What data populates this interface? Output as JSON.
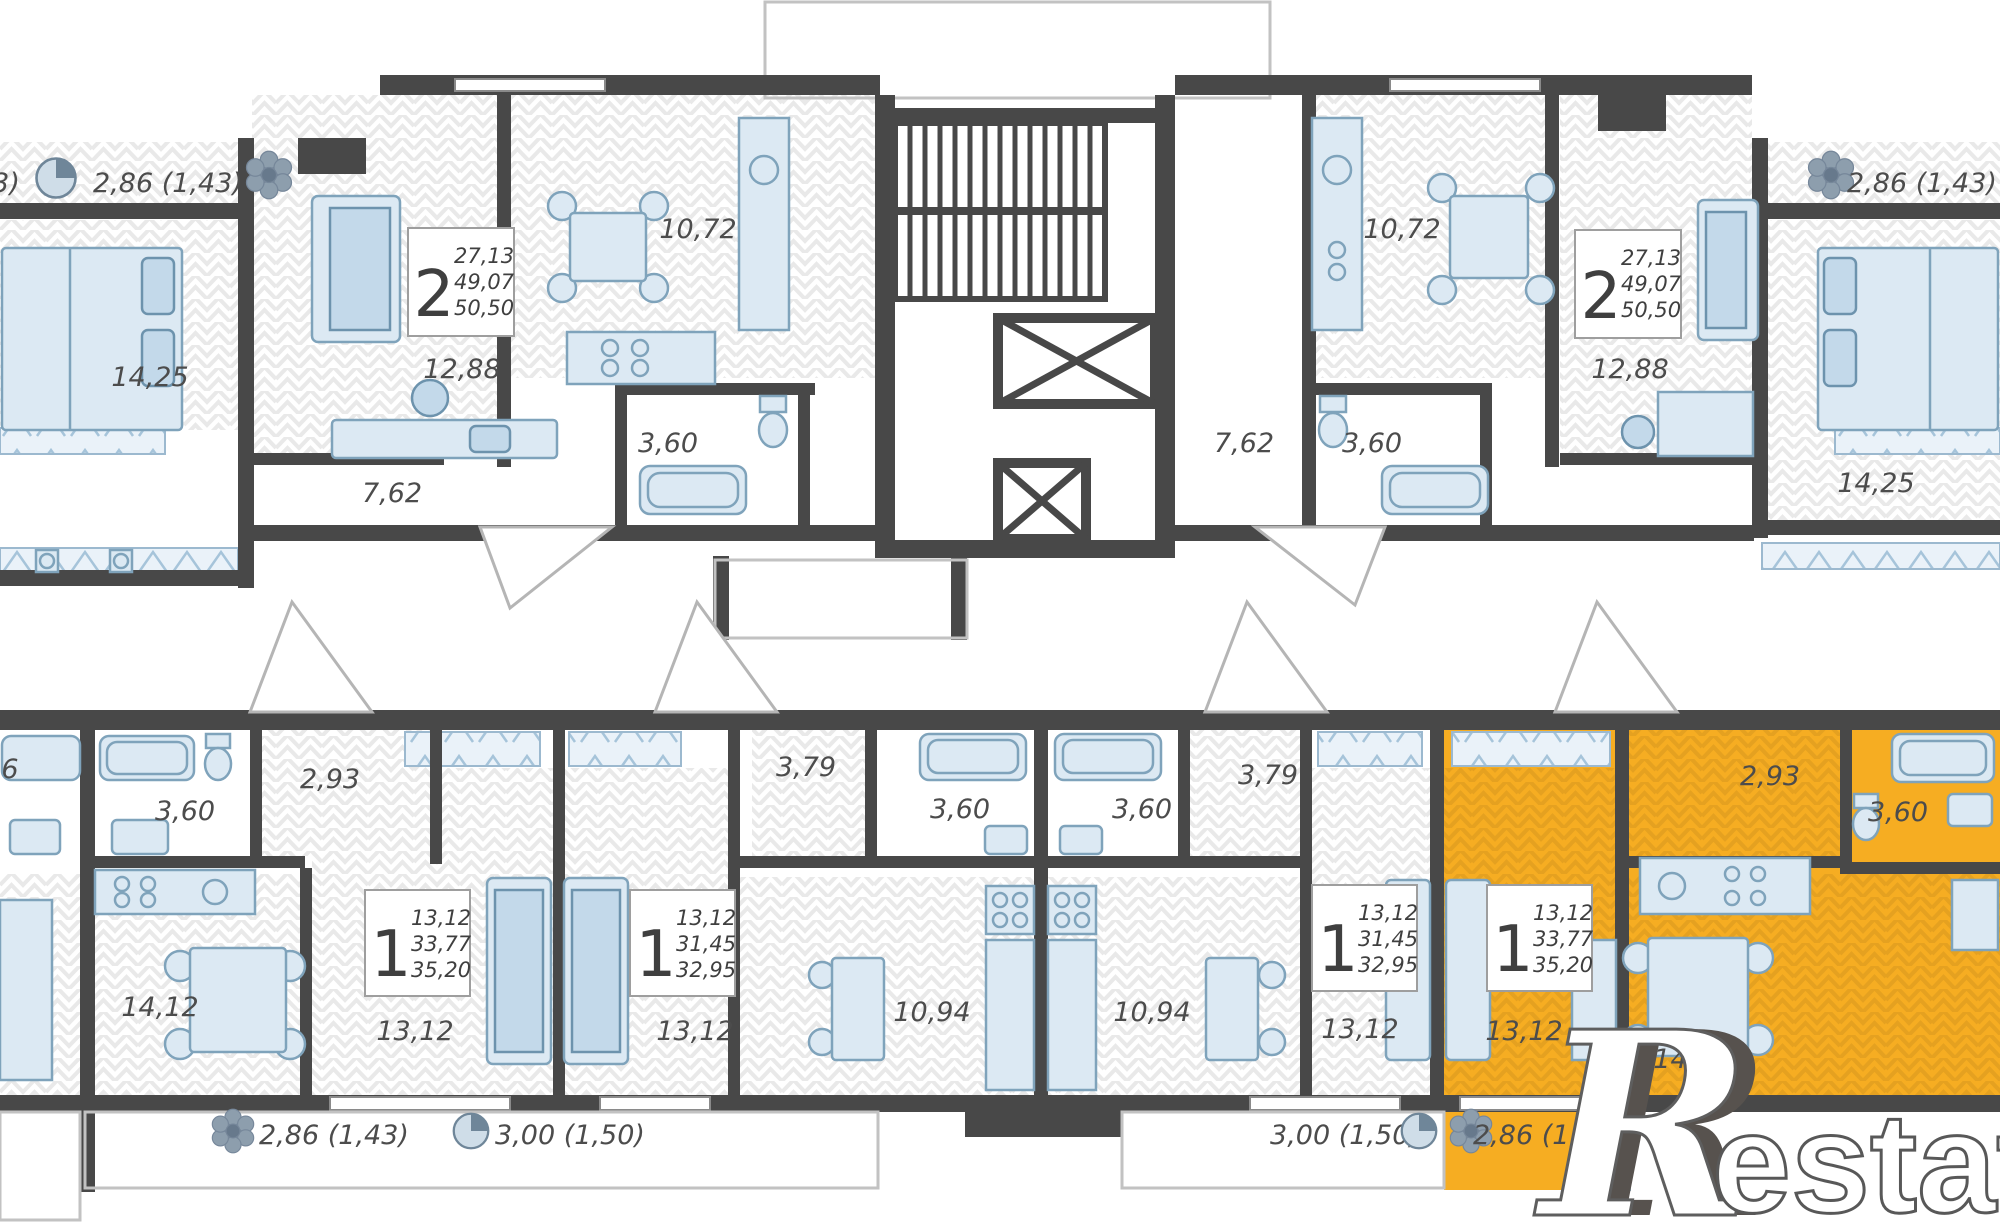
{
  "colors": {
    "highlight": "#F6AD22",
    "wall": "#484848"
  },
  "watermark": {
    "initial": "R",
    "rest": "estate"
  },
  "cards": {
    "top_left": {
      "rooms": "2",
      "area_living": "27,13",
      "area_apartment": "49,07",
      "area_total": "50,50"
    },
    "top_right": {
      "rooms": "2",
      "area_living": "27,13",
      "area_apartment": "49,07",
      "area_total": "50,50"
    },
    "bottom_a": {
      "rooms": "1",
      "area_living": "13,12",
      "area_apartment": "33,77",
      "area_total": "35,20"
    },
    "bottom_b": {
      "rooms": "1",
      "area_living": "13,12",
      "area_apartment": "31,45",
      "area_total": "32,95"
    },
    "bottom_c": {
      "rooms": "1",
      "area_living": "13,12",
      "area_apartment": "31,45",
      "area_total": "32,95"
    },
    "bottom_highlight": {
      "rooms": "1",
      "area_living": "13,12",
      "area_apartment": "33,77",
      "area_total": "35,20"
    }
  },
  "labels": {
    "top_left_cut": "3)",
    "top_left_balcony": "2,86 (1,43)",
    "top_left_bedroom": "14,25",
    "top_left_living": "12,88",
    "top_left_kitchen": "10,72",
    "top_left_bath": "3,60",
    "top_left_hall": "7,62",
    "top_right_kitchen": "10,72",
    "top_right_bath": "3,60",
    "top_right_hall": "7,62",
    "top_right_living": "12,88",
    "top_right_balcony": "2,86 (1,43)",
    "top_right_bedroom": "14,25",
    "bottom_edge_cut": "6",
    "a_hall": "2,93",
    "a_bath": "3,60",
    "a_kitchen": "14,12",
    "a_room": "13,12",
    "b_hall": "3,79",
    "b_bath": "3,60",
    "b_kitchen": "10,94",
    "b_room": "13,12",
    "c_hall": "3,79",
    "c_bath": "3,60",
    "c_kitchen": "10,94",
    "c_room": "13,12",
    "y_hall": "2,93",
    "y_bath": "3,60",
    "y_kitchen": "14,12",
    "y_room": "13,12",
    "balcony_left_1": "2,86 (1,43)",
    "balcony_left_2": "3,00 (1,50)",
    "balcony_right_1": "3,00 (1,50)",
    "balcony_right_2": "2,86 (1,43)"
  }
}
